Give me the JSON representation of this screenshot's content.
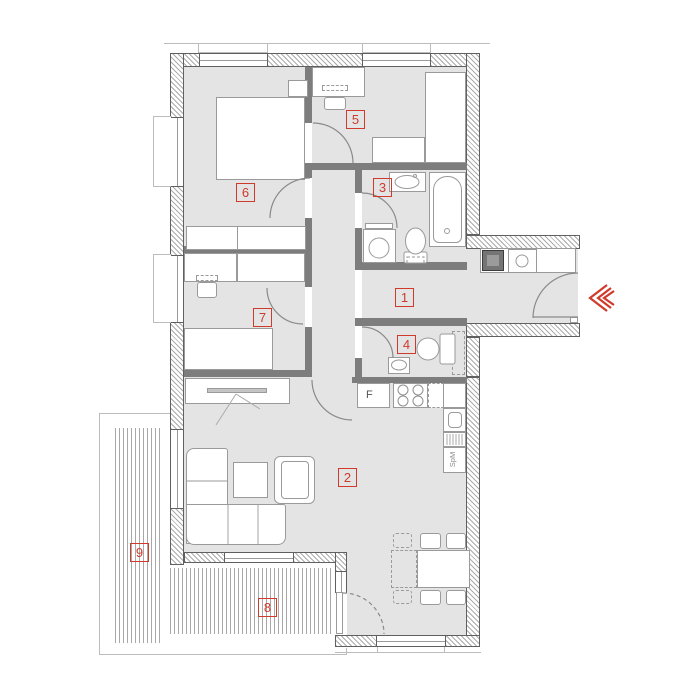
{
  "plan": {
    "title": "apartment-floor-plan",
    "room_labels": [
      {
        "label": "1"
      },
      {
        "label": "2"
      },
      {
        "label": "3"
      },
      {
        "label": "4"
      },
      {
        "label": "5"
      },
      {
        "label": "6"
      },
      {
        "label": "7"
      },
      {
        "label": "8"
      },
      {
        "label": "9"
      }
    ],
    "kitchen": {
      "fridge_label": "F",
      "dishwasher_label": "SpM"
    },
    "icons": {
      "entrance_arrow": "triple-chevron-left-icon"
    },
    "colors": {
      "accent_red": "#cf3a2b",
      "floor": "#e4e4e4",
      "interior_wall": "#7d7d7d",
      "furniture_outline": "#9a9a9a"
    }
  }
}
